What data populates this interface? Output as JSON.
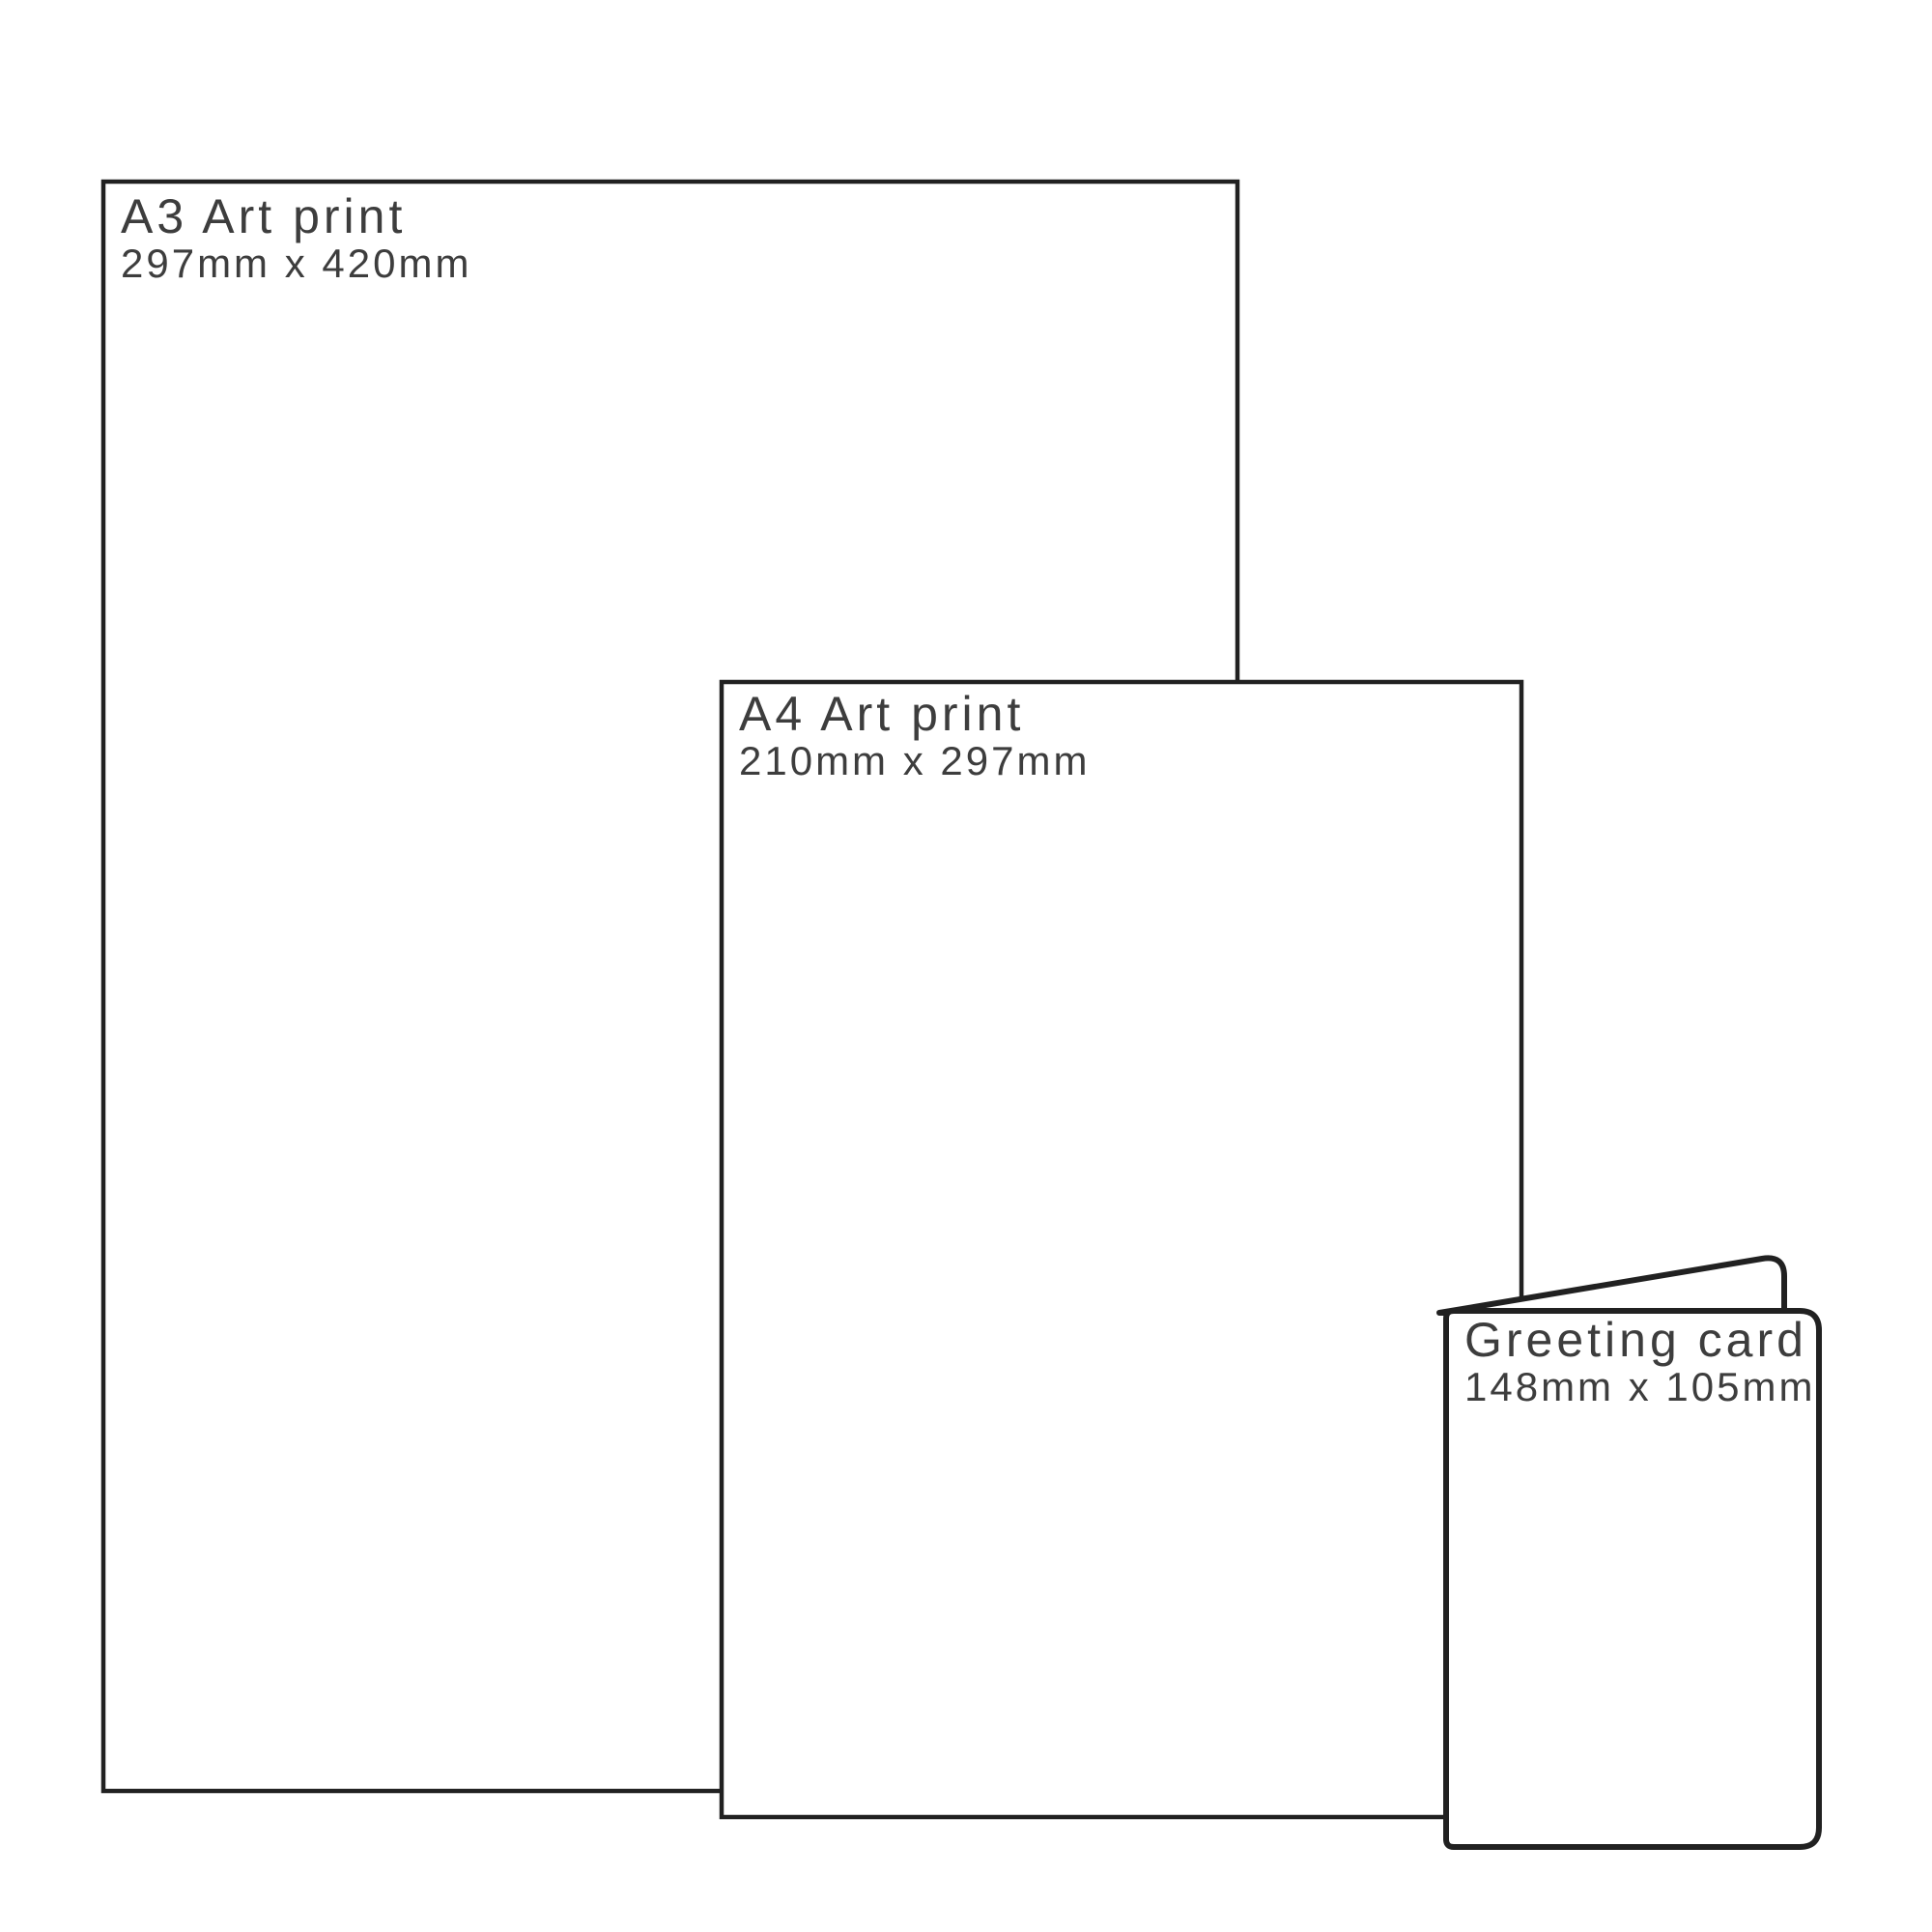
{
  "colors": {
    "outline": "#212121",
    "ink": "#3d3d3d",
    "paper": "#ffffff",
    "bg": "#ffffff"
  },
  "items": [
    {
      "id": "a3-art-print",
      "label": "A3 Art print",
      "dimensions": "297mm x 420mm"
    },
    {
      "id": "a4-art-print",
      "label": "A4 Art print",
      "dimensions": "210mm x 297mm"
    },
    {
      "id": "greeting-card",
      "label": "Greeting card",
      "dimensions": "148mm x 105mm"
    }
  ]
}
